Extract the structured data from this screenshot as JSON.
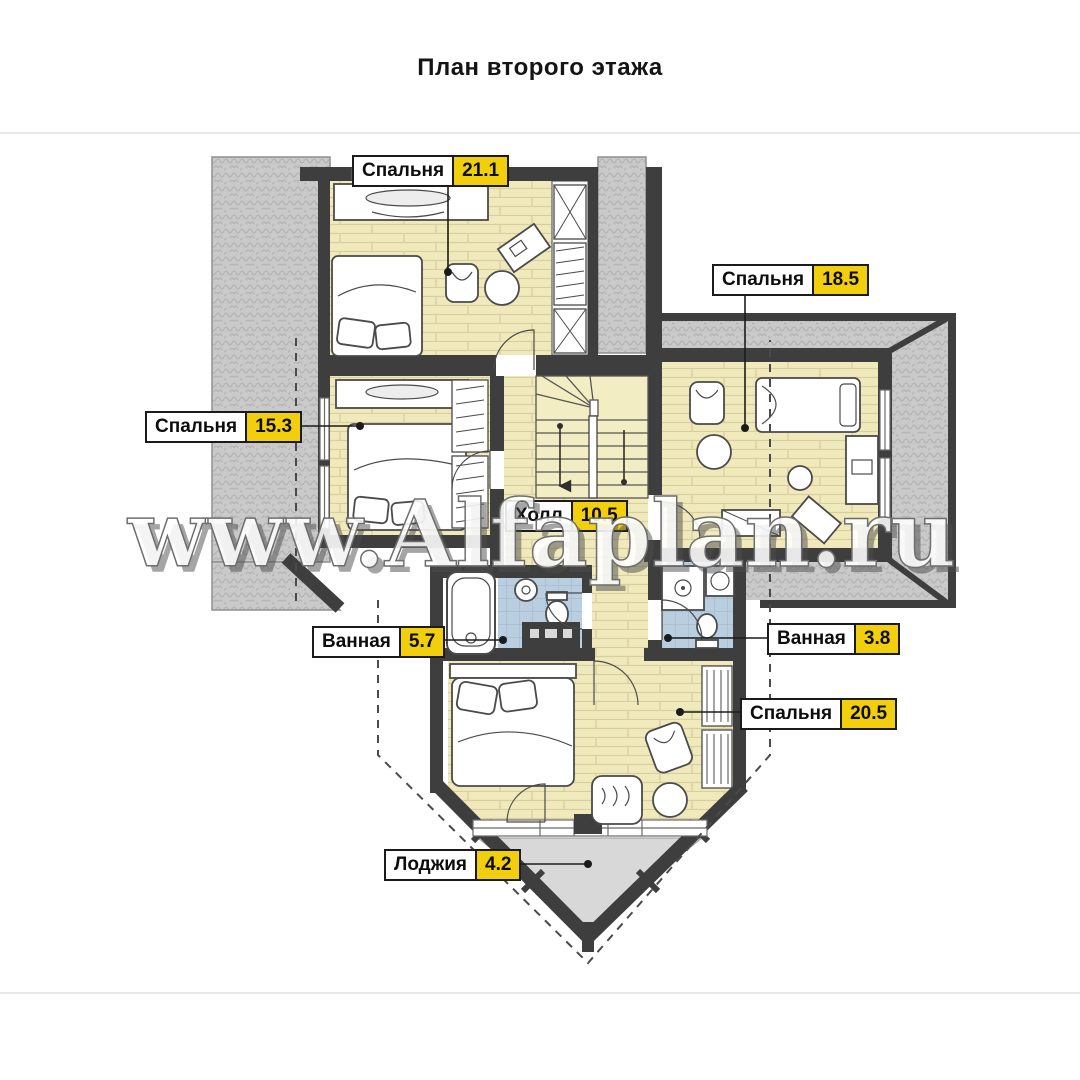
{
  "page": {
    "title": "План второго этажа"
  },
  "watermark": {
    "text": "www.Alfaplan.ru"
  },
  "colors": {
    "wall": "#3e3e3e",
    "room_floor": "#f0e9bc",
    "roof": "#c9c9c9",
    "bath_tile": "#b9cfe0",
    "loggia_floor": "#d8d8d8",
    "label_area_bg": "#f2cf0d",
    "label_border": "#1b1b1b"
  },
  "rooms": [
    {
      "name": "Спальня",
      "area": "21.1"
    },
    {
      "name": "Спальня",
      "area": "18.5"
    },
    {
      "name": "Спальня",
      "area": "15.3"
    },
    {
      "name": "Холл",
      "area": "10.5"
    },
    {
      "name": "Ванная",
      "area": "5.7"
    },
    {
      "name": "Ванная",
      "area": "3.8"
    },
    {
      "name": "Спальня",
      "area": "20.5"
    },
    {
      "name": "Лоджия",
      "area": "4.2"
    }
  ]
}
